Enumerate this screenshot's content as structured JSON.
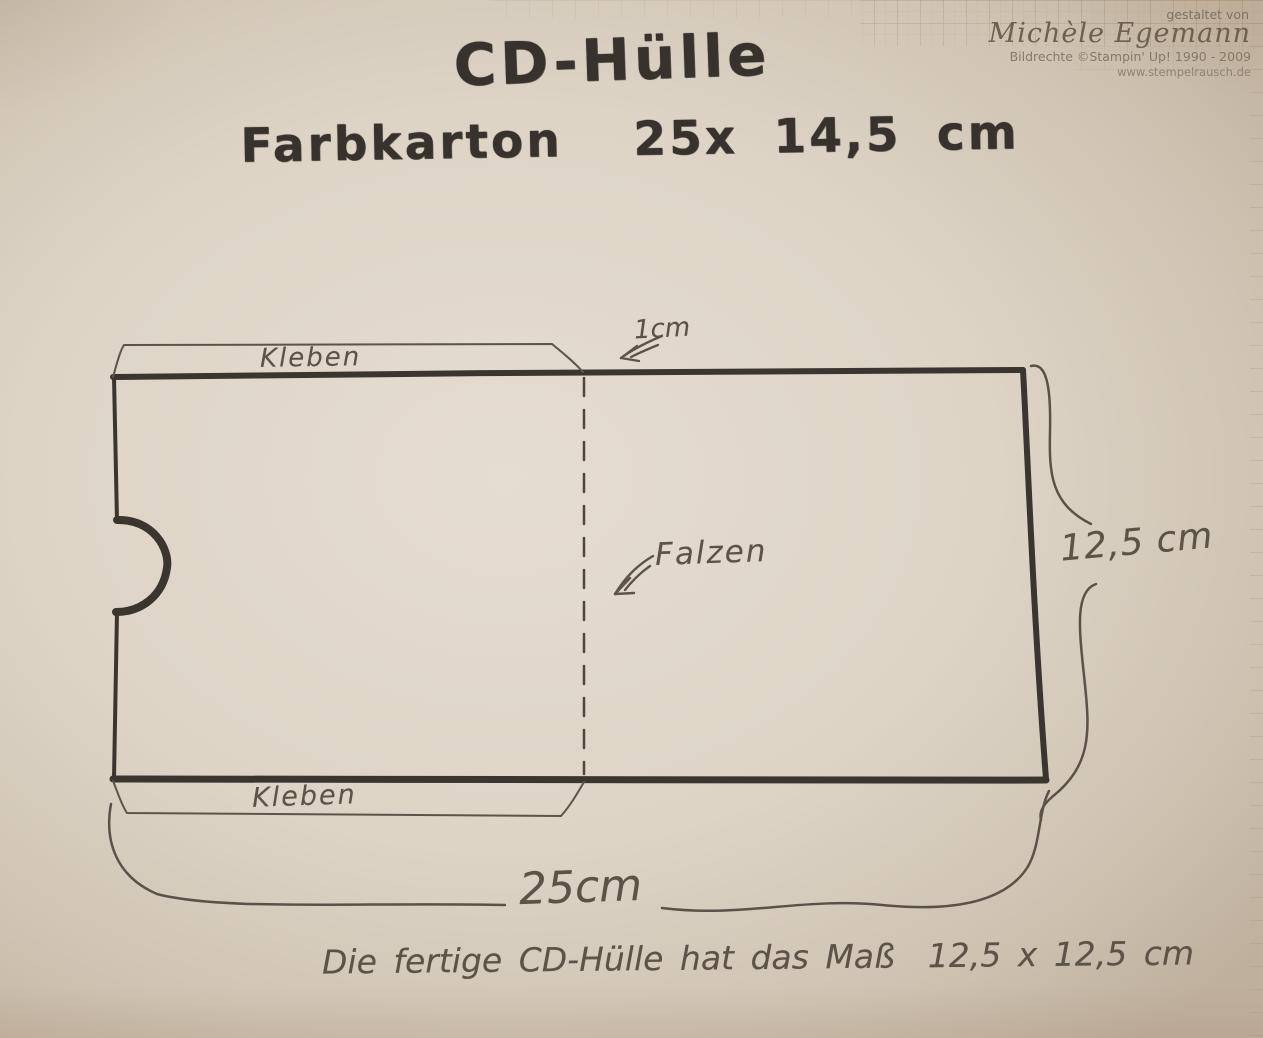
{
  "watermark": {
    "credit_prefix": "gestaltet von",
    "author": "Michèle Egemann",
    "rights": "Bildrechte ©Stampin' Up! 1990 - 2009",
    "website": "www.stempelrausch.de"
  },
  "title": {
    "name": "CD-Hülle",
    "material": "Farbkarton  25x 14,5 cm"
  },
  "diagram": {
    "glue_label_top": "Kleben",
    "glue_label_bottom": "Kleben",
    "flap_depth": "1cm",
    "fold_label": "Falzen",
    "side_dimension": "12,5 cm",
    "bottom_dimension": "25cm"
  },
  "footer": {
    "result_note": "Die fertige CD-Hülle hat das Maß  12,5 x 12,5 cm"
  },
  "colors": {
    "marker_ink": "#3a362f",
    "pencil_ink": "#5c544a",
    "paper_center": "#e5ddd0",
    "paper_edge": "#bfb09d",
    "grid_line": "#9b7f5e"
  }
}
